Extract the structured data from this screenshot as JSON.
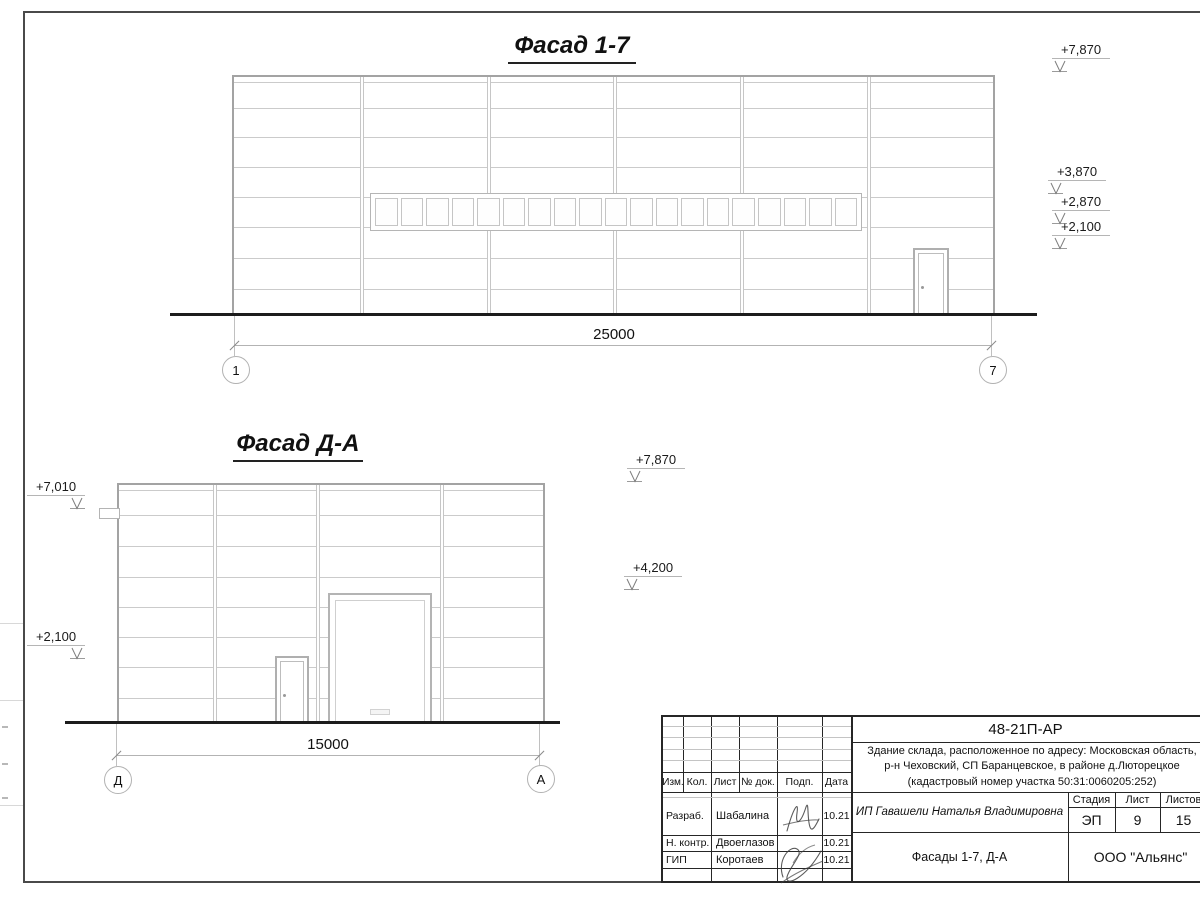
{
  "facade17": {
    "title": "Фасад 1-7",
    "dim": "25000",
    "grid_left": "1",
    "grid_right": "7",
    "elevations": [
      "+7,870",
      "+3,870",
      "+2,870",
      "+2,100"
    ],
    "window_panes": 19
  },
  "facadeDA": {
    "title": "Фасад Д-А",
    "dim": "15000",
    "grid_left": "Д",
    "grid_right": "А",
    "elev_right_top": "+7,870",
    "elev_right_mid": "+4,200",
    "elev_left_top": "+7,010",
    "elev_left_bottom": "+2,100"
  },
  "titleblock": {
    "doc_number": "48-21П-АР",
    "project": {
      "line1": "Здание склада, расположенное по адресу: Московская область,",
      "line2": "р-н Чеховский, СП Баранцевское, в районе д.Люторецкое",
      "line3": "(кадастровый номер участка 50:31:0060205:252)"
    },
    "rev_headers": [
      "Изм.",
      "Кол.",
      "Лист",
      "№ док.",
      "Подп.",
      "Дата"
    ],
    "staff": [
      {
        "role": "Разраб.",
        "name": "Шабалина",
        "date": "10.21"
      },
      {
        "role": "Н. контр.",
        "name": "Двоеглазов",
        "date": "10.21"
      },
      {
        "role": "ГИП",
        "name": "Коротаев",
        "date": "10.21"
      }
    ],
    "client": "ИП Гавашели Наталья Владимировна",
    "stage_header": "Стадия",
    "sheet_header": "Лист",
    "sheets_header": "Листов",
    "stage": "ЭП",
    "sheet": "9",
    "sheets": "15",
    "sheet_title": "Фасады 1-7, Д-А",
    "organization": "ООО \"Альянс\""
  }
}
